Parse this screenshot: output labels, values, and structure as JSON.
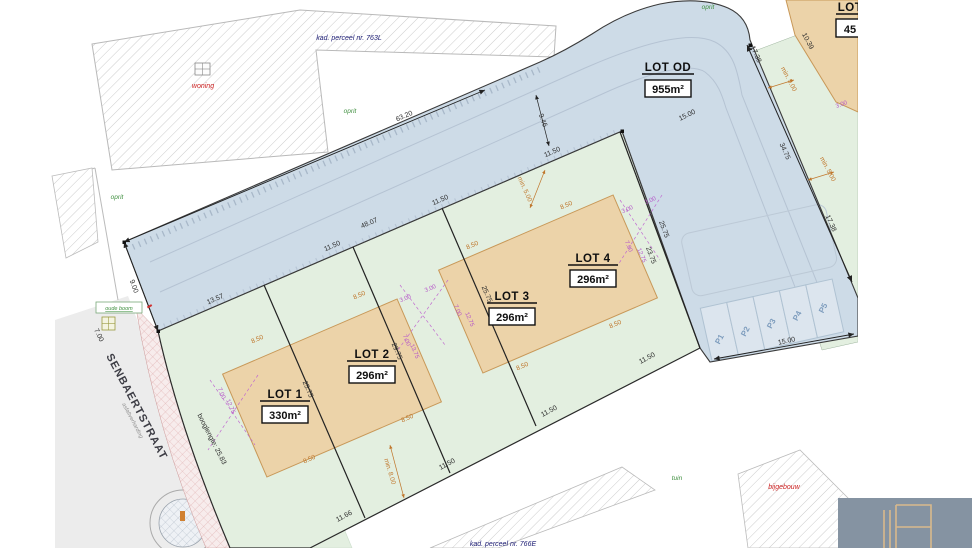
{
  "map": {
    "lots": {
      "lot1": {
        "label": "LOT 1",
        "area": "330m²"
      },
      "lot2": {
        "label": "LOT 2",
        "area": "296m²"
      },
      "lot3": {
        "label": "LOT 3",
        "area": "296m²"
      },
      "lot4": {
        "label": "LOT 4",
        "area": "296m²"
      },
      "lot_od": {
        "label": "LOT OD",
        "area": "955m²"
      },
      "lot_ne": {
        "label": "LOT",
        "area": "45"
      }
    },
    "parking": {
      "p1": "P1",
      "p2": "P2",
      "p3": "P3",
      "p4": "P4",
      "p5": "P5"
    },
    "dimensions": {
      "top_boundary": "63.20",
      "left_edge": "9.00",
      "street_front": "13.57",
      "front_total": "48.07",
      "lot_width": "11.50",
      "lot_width_first": "11.66",
      "depth_a": "25.75",
      "depth_b": "29.75",
      "depth_c": "23.75",
      "east_top": "17.38",
      "east_mid": "34.75",
      "east_bot": "17.38",
      "parking_width": "15.00",
      "road_width": "9.46",
      "road_end": "15.00",
      "ne_edge": "10.39",
      "street_top": "7.00",
      "min_front": "min. 5.00",
      "min_rear": "min. 8.00",
      "house_width": "8.50",
      "gap": "3.00",
      "side": "7.00",
      "house_depth": "12.75",
      "house_depth_b": "13.75",
      "arc": "booglengte: 25.83"
    },
    "labels": {
      "kad_top": "kad. perceel nr. 763L",
      "kad_bottom": "kad. perceel nr. 766E",
      "woning": "woning",
      "oprit": "oprit",
      "tuin": "tuin",
      "bijgebouw": "bijgebouw",
      "green_note": "oude boom",
      "street_name": "SENBAERTSTRAAT",
      "street_surface": "asfaltverharding"
    },
    "colors": {
      "road": "#cddbe7",
      "parcel_green": "#e3efe0",
      "building_tan": "#ecd3a9",
      "accent_orange": "#c0772c",
      "accent_purple": "#b455c8",
      "label_green": "#3f8f3f",
      "label_red": "#cc2222",
      "label_navy": "#1a1a72",
      "logo_bg": "#8593a2",
      "logo_line": "#d9b98c"
    }
  }
}
